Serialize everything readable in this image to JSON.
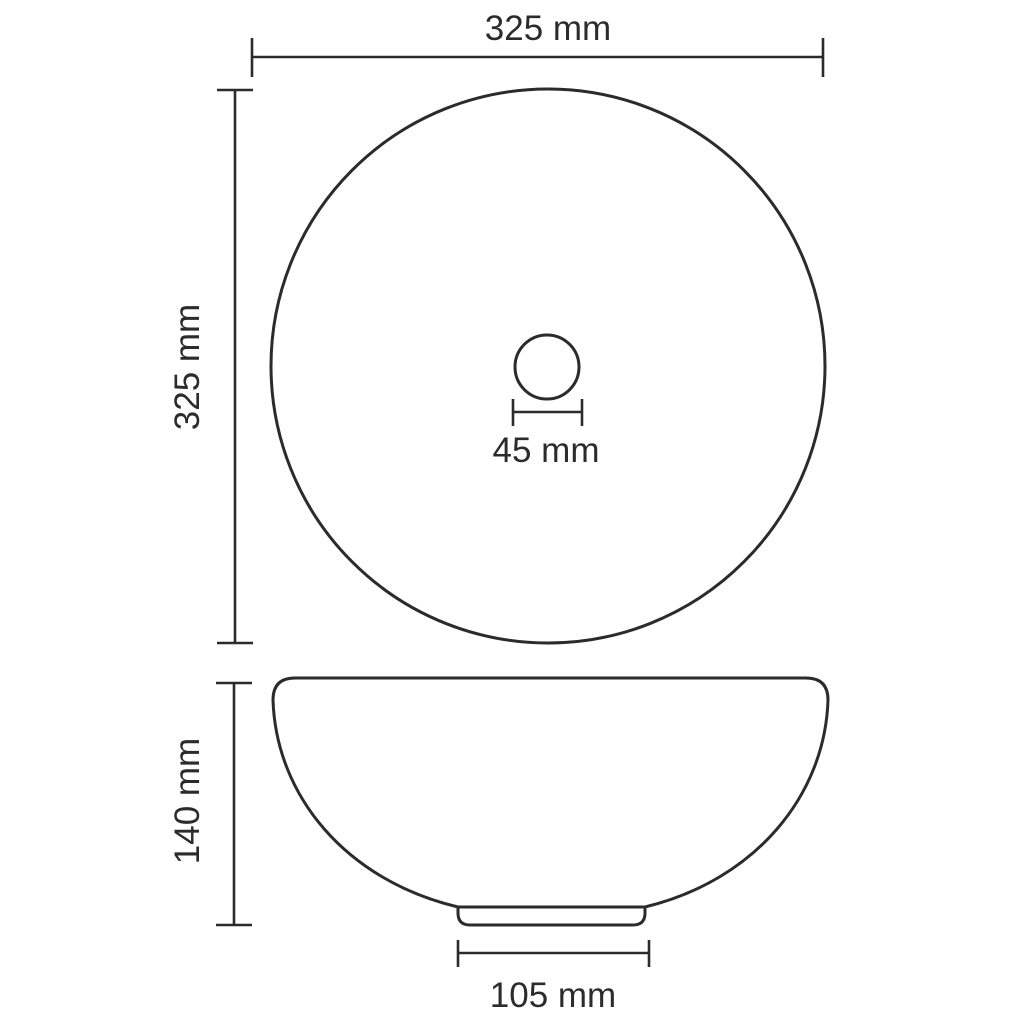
{
  "colors": {
    "stroke": "#2b2b2b",
    "background": "#ffffff"
  },
  "drawing": {
    "kind": "technical dimension drawing of a round wash basin (top view and side view)"
  },
  "top_view": {
    "outer_diameter_label": "325 mm",
    "vertical_diameter_label": "325 mm",
    "drain_diameter_label": "45 mm"
  },
  "side_view": {
    "height_label": "140 mm",
    "base_width_label": "105 mm"
  }
}
